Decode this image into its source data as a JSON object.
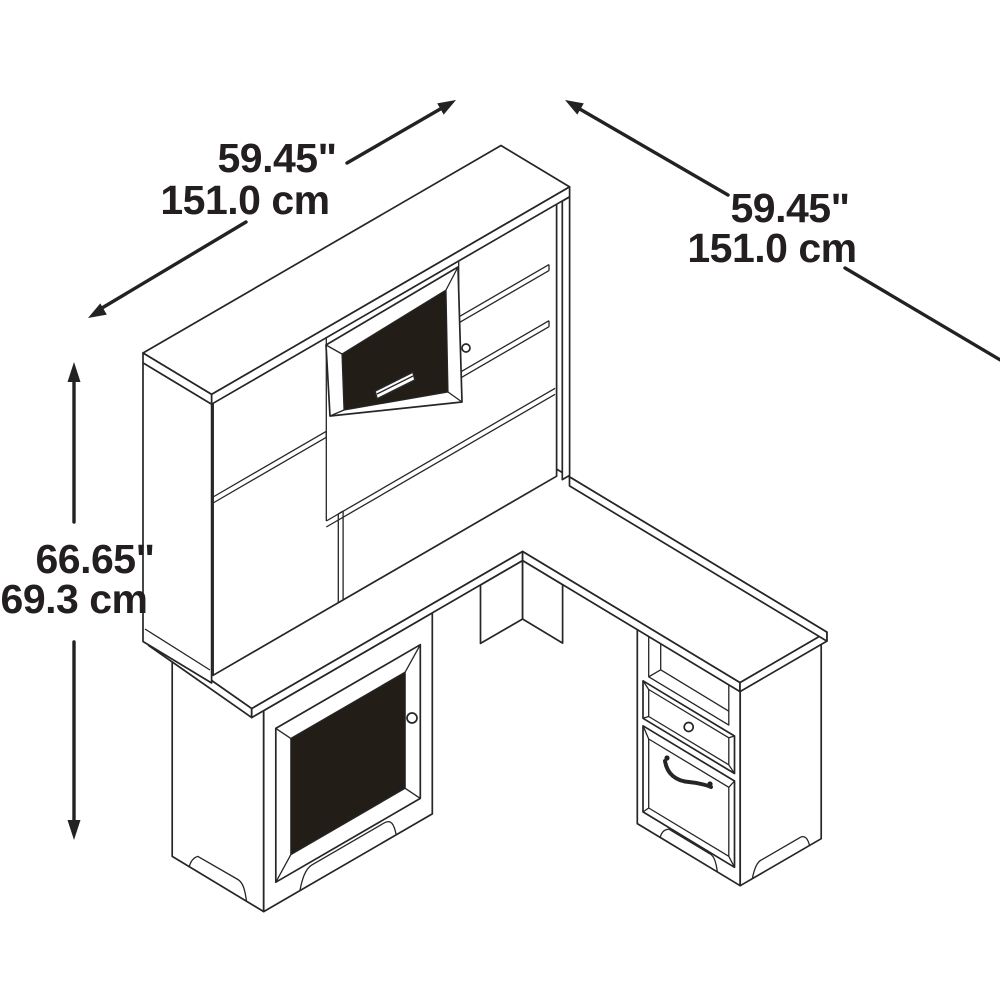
{
  "dimensions": {
    "hutch_width": {
      "inches": "59.45\"",
      "cm": "151.0 cm"
    },
    "return_length": {
      "inches": "59.45\"",
      "cm": "151.0 cm"
    },
    "height": {
      "inches": "66.65\"",
      "cm": "69.3 cm"
    }
  },
  "colors": {
    "line": "#262626",
    "glass_panel": "#231d18",
    "text": "#231f20",
    "background": "#ffffff"
  }
}
